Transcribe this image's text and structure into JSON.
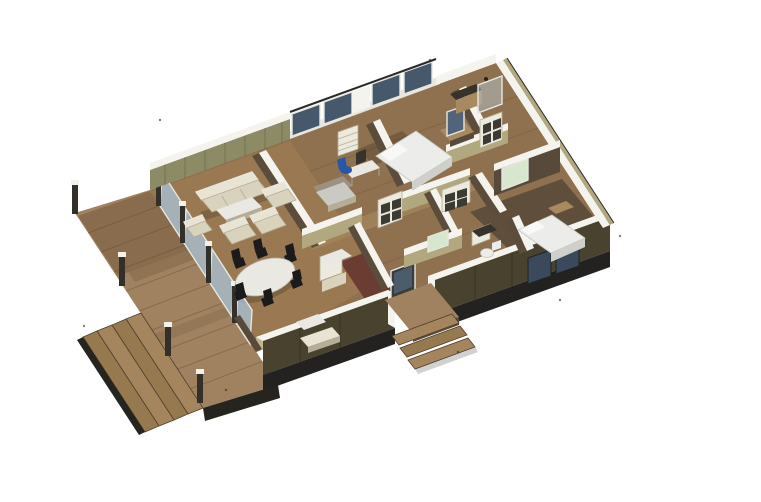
{
  "scene": {
    "palette": {
      "bg": "#ffffff",
      "deck_wood": "#a08260",
      "deck_fascia": "#26241f",
      "stair_light": "#a5855e",
      "stair_mid": "#97794f",
      "post_dark": "#33302a",
      "post_cap": "#f2f1ec",
      "floor_wood": "#8f7150",
      "floor_warm": "#9a7952",
      "floor_corridor": "#a5875c",
      "floor_dark": "#5f4e3b",
      "floor_red": "#6a3c32",
      "rug_gray": "#9a9183",
      "counter_gray": "#cbc9c4",
      "wall_cap": "#f4f3ee",
      "wall_olive": "#8d8a66",
      "wall_khaki": "#b2a87f",
      "wall_khaki_light": "#c2b78c",
      "wall_dark_face": "#5b4c3c",
      "wall_closet_dark": "#584a3b",
      "wall_ext_dark": "#49422f",
      "base_dark": "#232220",
      "glass_dark": "#46586c",
      "glass_mid": "#4d5c6b",
      "glass_se": "#3a4a5c",
      "glass_light": "rgba(168,196,216,0.75)",
      "glass_shower": "rgba(185,198,205,0.5)",
      "frame_white": "#e7e6df",
      "furn_cream": "#d9d2bd",
      "furn_cream_light": "#e8e3d3",
      "furn_cream_dark": "#b5ad96",
      "table_top": "#eae8e2",
      "chair_black": "#1b1b1b",
      "bed_top": "#ececea",
      "bed_side": "#cfcfcb",
      "pillow_white": "#f8f8f7",
      "wood_tan": "#a9895e",
      "counter_dark": "#36332c",
      "screen_slate": "#51647c",
      "door_green": "#d7e6cf",
      "door_dark": "#3b3b39",
      "panel_white": "#eceadf",
      "panel_inset": "#3b3b33",
      "chair_blue": "#2857a4",
      "shadow_warm": "rgba(80,55,30,0.28)",
      "shadow_soft": "rgba(0,0,0,0.18)"
    }
  }
}
